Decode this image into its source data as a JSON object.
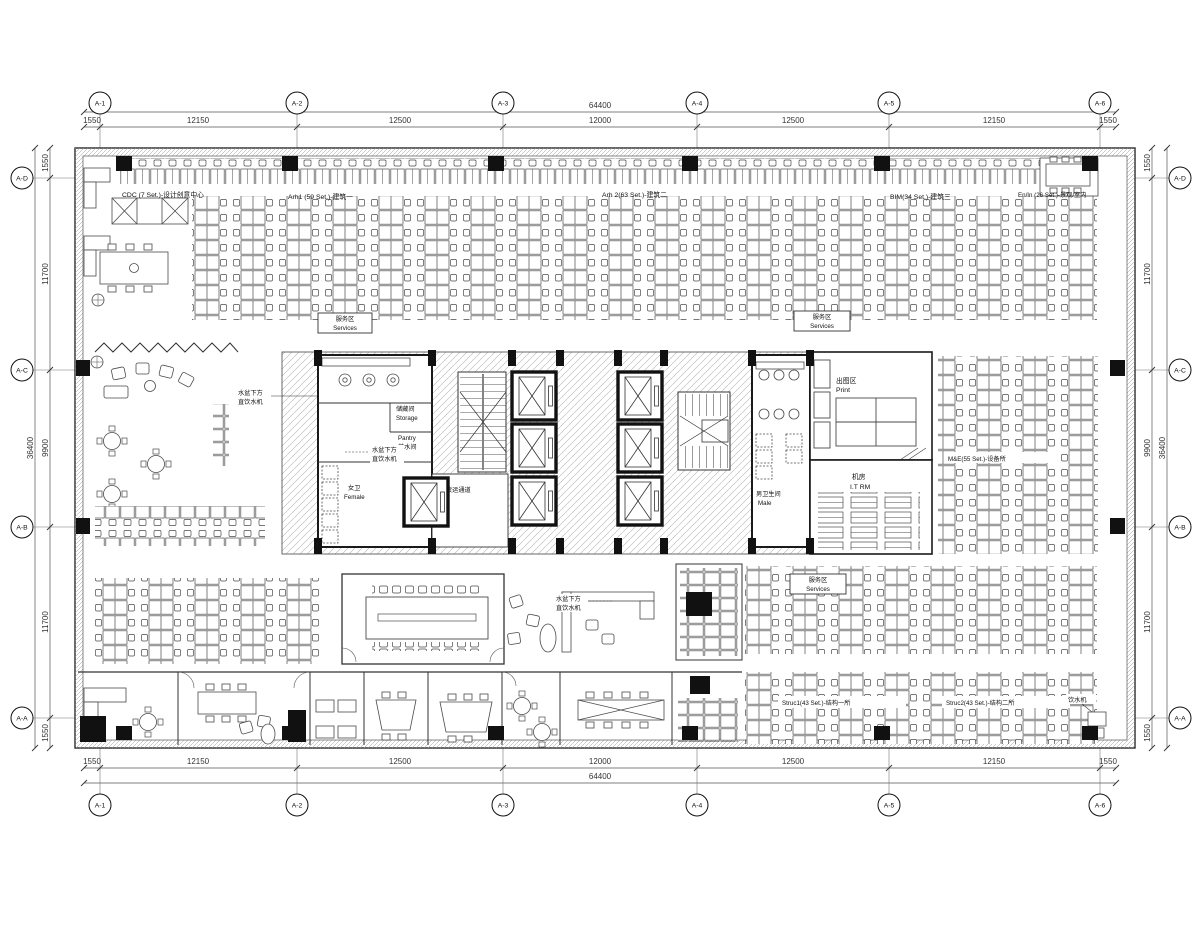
{
  "grid": {
    "cols": [
      "A-1",
      "A-2",
      "A-3",
      "A-4",
      "A-5",
      "A-6"
    ],
    "rows": [
      "A-D",
      "A-C",
      "A-B",
      "A-A"
    ],
    "h_dims": [
      "1550",
      "12150",
      "12500",
      "12000",
      "12500",
      "12150",
      "1550"
    ],
    "h_total": "64400",
    "v_dims": [
      "1550",
      "11700",
      "9900",
      "11700",
      "1550"
    ],
    "v_total": "36400"
  },
  "areas": {
    "cdc": "CDC (7 Set.)-设计创意中心",
    "arh1": "Arh1 (59 Set.)-建筑一",
    "arh2": "Arh 2(63 Set.)-建筑二",
    "bim": "BIM(34 Set.)-建筑三",
    "enin": "En/In (26 Set.)-景观/室内",
    "me": "M&E(55 Set.)-设备所",
    "struc1": "Struc1(43 Set.)-结构一所",
    "struc2": "Struc2(43 Set.)-结构二所"
  },
  "rooms": {
    "services_cn": "服务区",
    "services_en": "Services",
    "storage_cn": "储藏间",
    "storage_en": "Storage",
    "pantry_en": "Pantry",
    "pantry_cn": "茶水间",
    "female_cn": "女卫",
    "female_en": "Female",
    "male_cn": "男卫生间",
    "male_en": "Male",
    "print_cn": "出图区",
    "print_en": "Print",
    "it_cn": "机房",
    "it_en": "I.T RM",
    "freight": "货运通道"
  },
  "annotations": {
    "water_l1": "水盆下方",
    "water_l2": "直饮水机",
    "drink": "饮水机"
  },
  "colors": {
    "wall": "#1a1a1a",
    "line": "#4a4a4a",
    "hatch": "#a8a8a8"
  }
}
